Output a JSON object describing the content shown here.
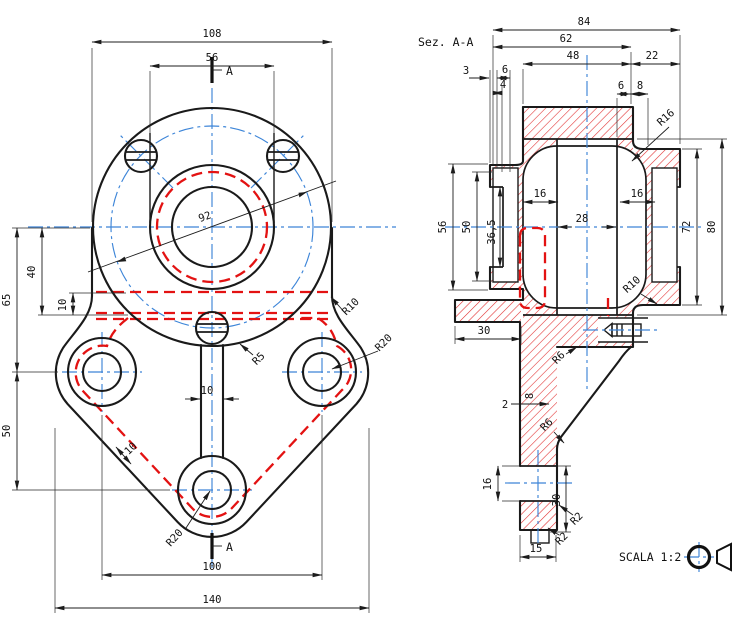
{
  "front_view": {
    "section_marker_top": "A",
    "section_marker_bottom": "A",
    "dims": {
      "width_flange": "108",
      "width_boss": "56",
      "bolt_circle": "92",
      "height_center_to_side_holes": "65",
      "height_40": "40",
      "plate_thickness": "10",
      "height_side_to_bottom_hole": "50",
      "rib_width": "10",
      "plate_thickness_slant": "10",
      "hole_spacing": "100",
      "width_overall": "140",
      "fillet_body": "R10",
      "lobe_radius_right": "R20",
      "lobe_radius_bottom": "R20",
      "rib_fillet": "R5"
    }
  },
  "section_view": {
    "title": "Sez. A-A",
    "dims": {
      "length_overall": "84",
      "length_62": "62",
      "length_48": "48",
      "length_22": "22",
      "step_3": "3",
      "step_4": "4",
      "step_6": "6",
      "depth_6": "6",
      "depth_8": "8",
      "boss_diameter": "56",
      "bearing_bore": "50",
      "inner_bore": "36,5",
      "seat_depth_left": "16",
      "seat_depth_right": "16",
      "shaft_bore": "28",
      "cavity_diameter": "72",
      "hub_diameter": "80",
      "fillet_r16": "R16",
      "fillet_r10": "R10",
      "gusset_fillet_top": "R6",
      "gusset_fillet_bottom": "R6",
      "arm_length": "30",
      "wall_step": "2",
      "wall_thickness": "8",
      "foot_hole": "16",
      "foot_height": "30",
      "foot_width": "15",
      "foot_fillet_a": "R2",
      "foot_fillet_b": "R2"
    }
  },
  "footer": {
    "scale_label": "SCALA 1:2"
  }
}
